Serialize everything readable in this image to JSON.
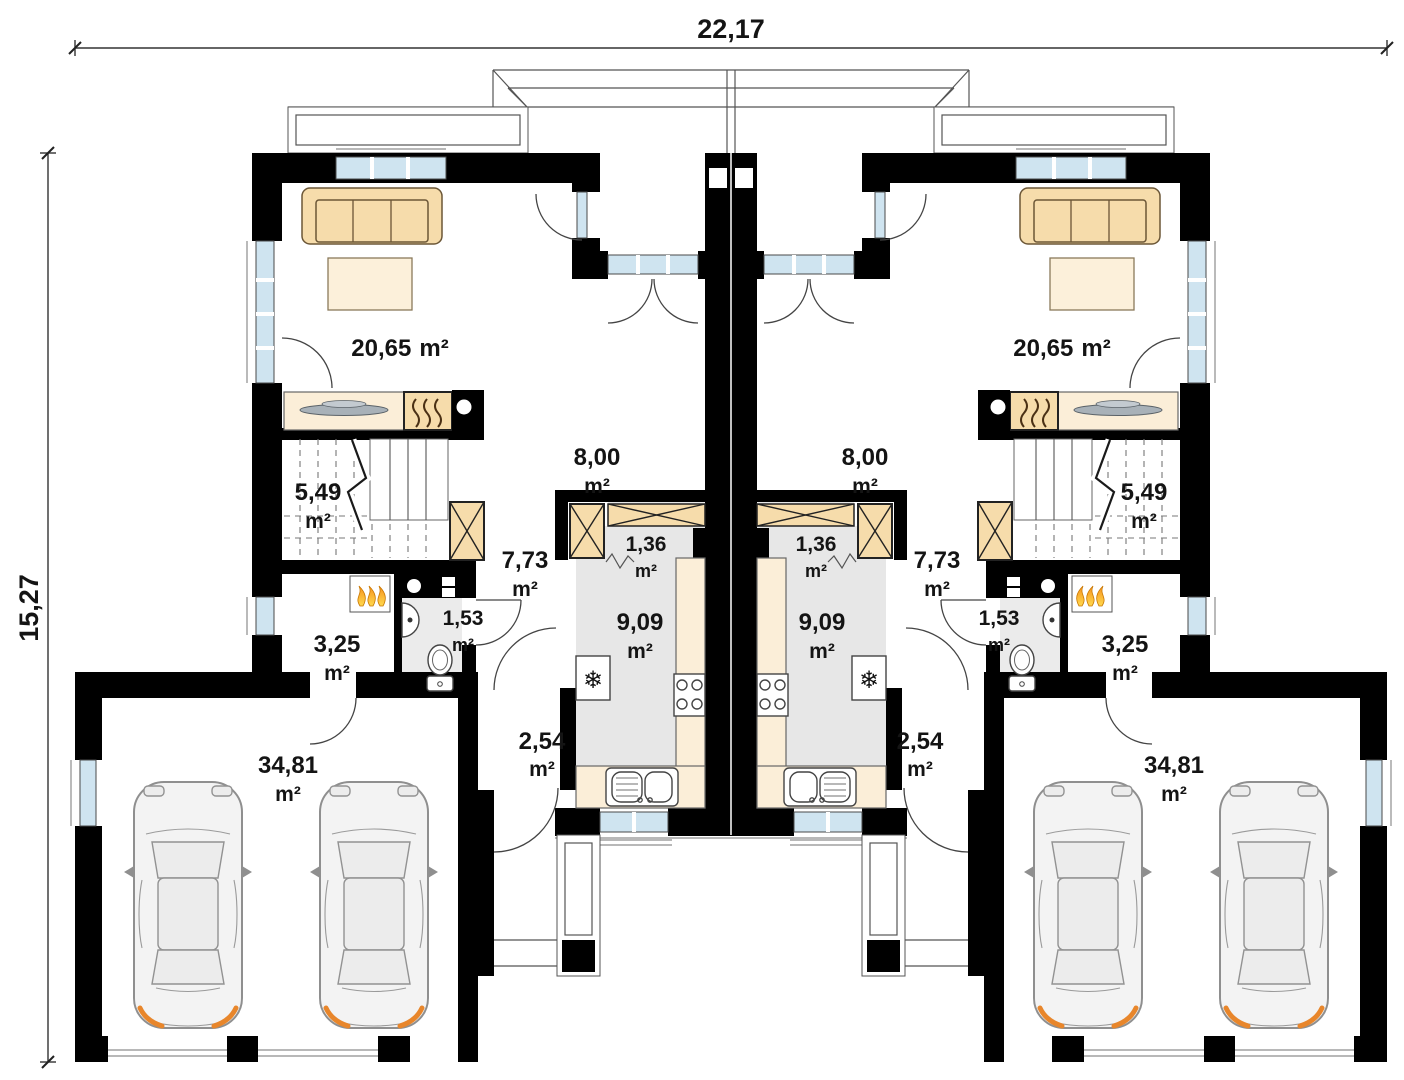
{
  "dimensions": {
    "overall_width": "22,17",
    "overall_height": "15,27"
  },
  "unit_suffix": "m²",
  "rooms": {
    "living": "20,65",
    "dining": "8,00",
    "stairs": "5,49",
    "hall": "7,73",
    "pantry": "1,36",
    "kitchen": "9,09",
    "wc": "1,53",
    "boiler": "3,25",
    "vestibule": "2,54",
    "garage": "34,81"
  },
  "icons": {
    "fridge_snowflake": "❄"
  },
  "colors": {
    "wall": "#000000",
    "furniture": "#f6dcab",
    "furniture_light": "#fbeed8",
    "window_glass": "#cfe4f0",
    "floor_gray": "#e7e7e7",
    "flame_orange": "#f6a01f",
    "car_accent": "#e8862b"
  }
}
